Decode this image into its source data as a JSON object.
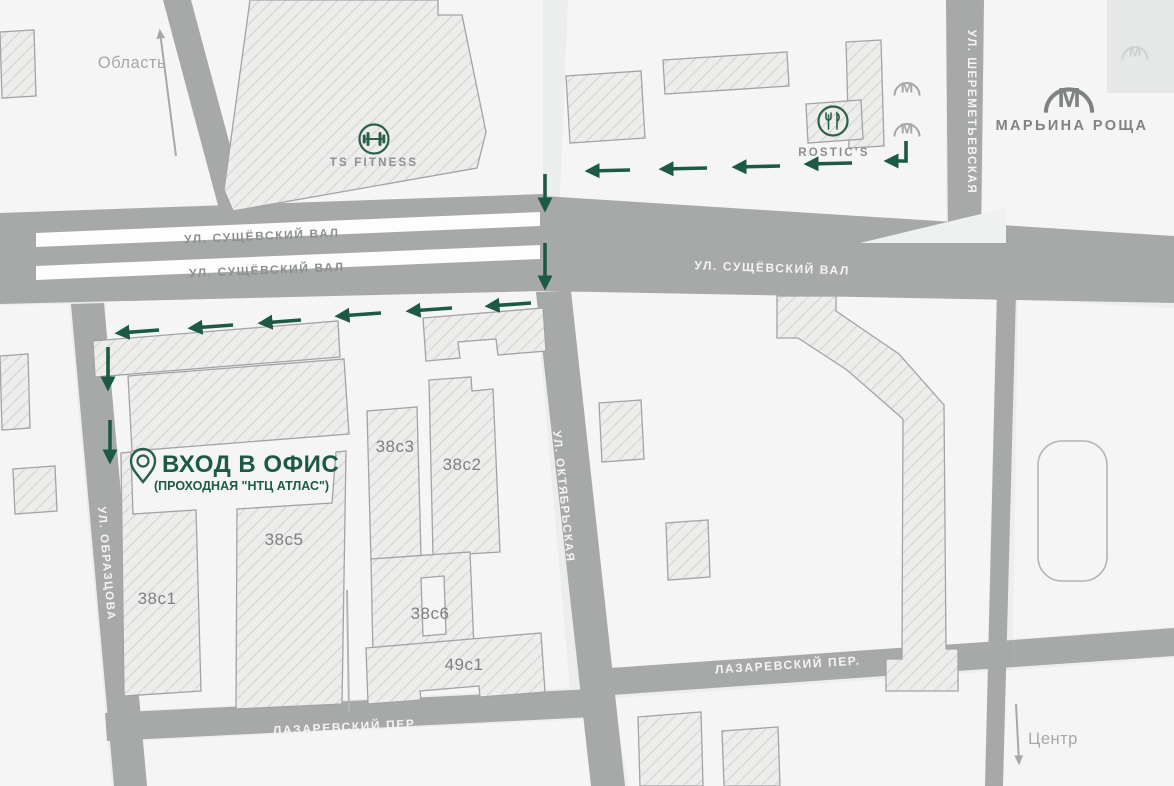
{
  "map": {
    "directions": {
      "north": "Область",
      "south": "Центр"
    },
    "streets": {
      "suschevsky_val": "УЛ. СУЩЁВСКИЙ ВАЛ",
      "sheremetyevskaya": "УЛ. ШЕРЕМЕТЬЕВСКАЯ",
      "oktyabrskaya": "УЛ. ОКТЯБРЬСКАЯ",
      "obraztsova": "УЛ. ОБРАЗЦОВА",
      "lazarevsky": "ЛАЗАРЕВСКИЙ ПЕР."
    },
    "pois": {
      "fitness_label": "TS FITNESS",
      "restaurant_label": "ROSTIC'S"
    },
    "metro": {
      "station_label": "МАРЬИНА РОЩА",
      "letter": "М"
    },
    "entrance": {
      "title": "ВХОД В ОФИС",
      "subtitle": "(ПРОХОДНАЯ \"НТЦ АТЛАС\")"
    },
    "buildings": [
      "38с3",
      "38с2",
      "38с5",
      "38с1",
      "38с6",
      "49с1"
    ],
    "colors": {
      "route_green": "#1d5a44",
      "road_gray": "#a7a9a8",
      "background": "#eef0ef",
      "metro_gray": "#7e8281",
      "building_fill": "#ededec"
    }
  }
}
